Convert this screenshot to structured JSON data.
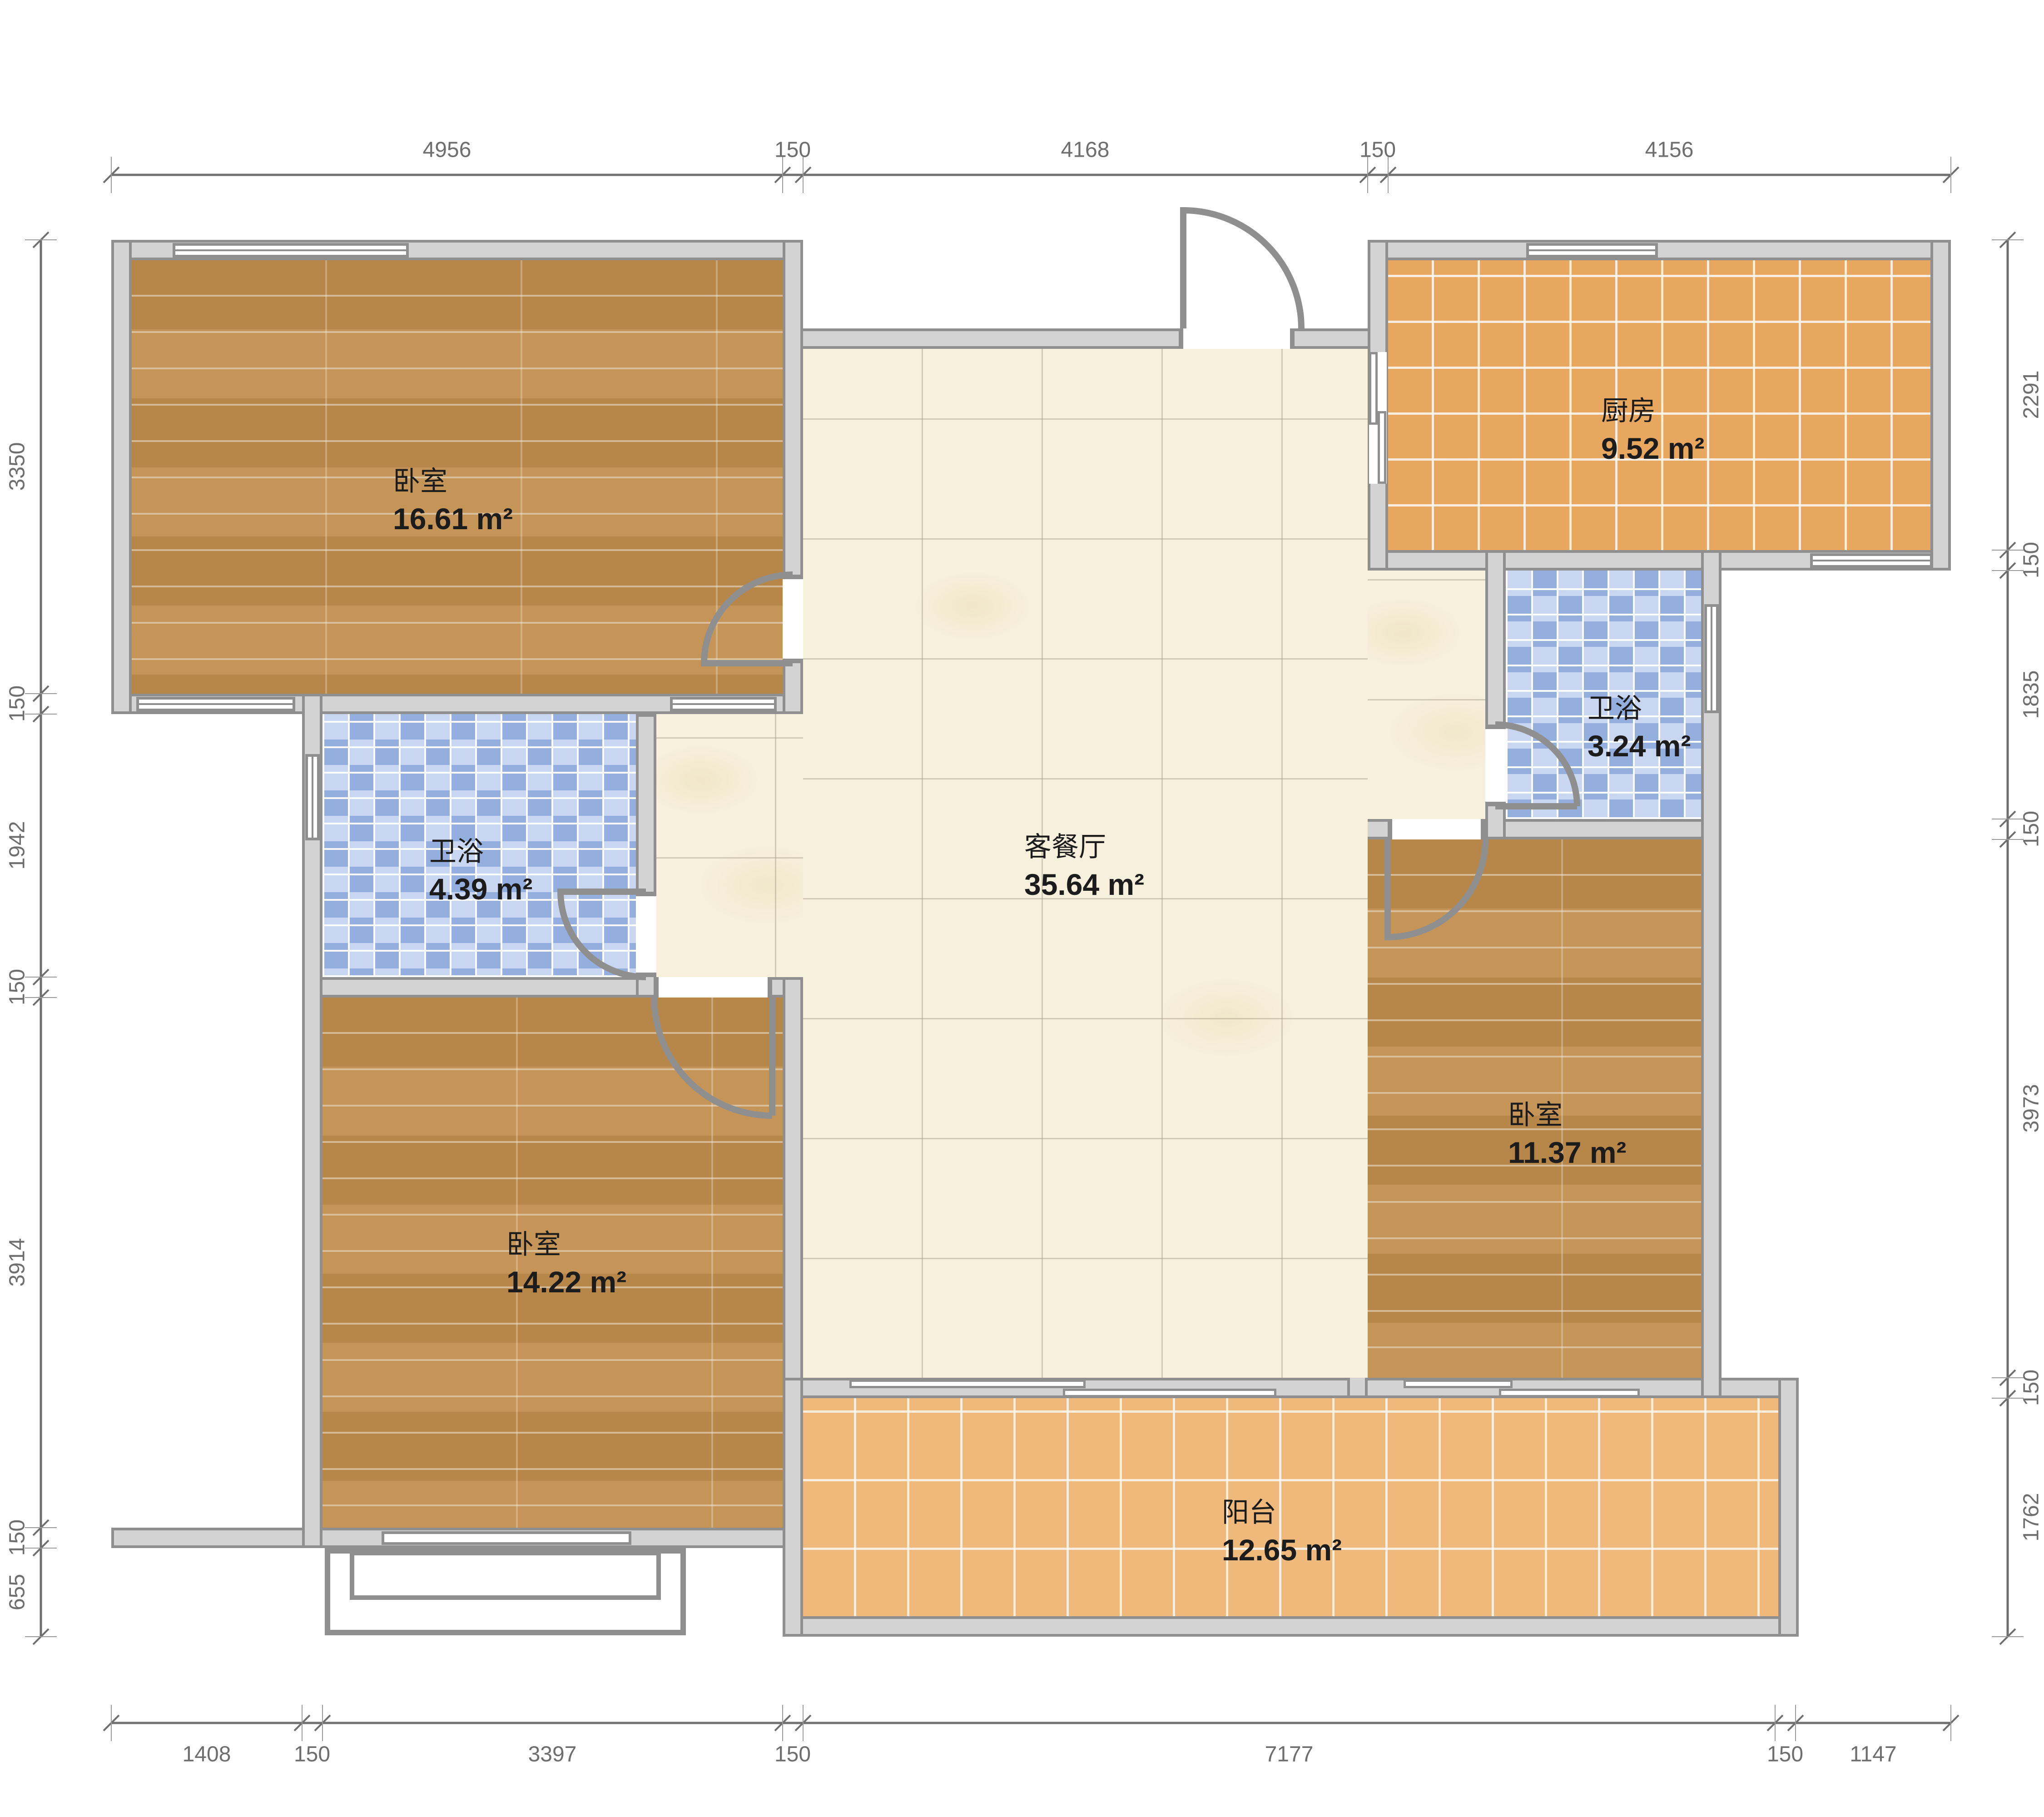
{
  "rooms": {
    "bedroom_top_left": {
      "name": "卧室",
      "area": "16.61 m²"
    },
    "kitchen": {
      "name": "厨房",
      "area": "9.52 m²"
    },
    "bath_left": {
      "name": "卫浴",
      "area": "4.39 m²"
    },
    "bath_right": {
      "name": "卫浴",
      "area": "3.24 m²"
    },
    "living_dining": {
      "name": "客餐厅",
      "area": "35.64 m²"
    },
    "bedroom_bottom_left": {
      "name": "卧室",
      "area": "14.22 m²"
    },
    "bedroom_right": {
      "name": "卧室",
      "area": "11.37 m²"
    },
    "balcony": {
      "name": "阳台",
      "area": "12.65 m²"
    }
  },
  "dimensions_mm": {
    "top": [
      "4956",
      "150",
      "4168",
      "150",
      "4156"
    ],
    "bottom": [
      "1408",
      "150",
      "3397",
      "150",
      "7177",
      "150",
      "1147"
    ],
    "left": [
      "3350",
      "150",
      "1942",
      "150",
      "3914",
      "150",
      "655"
    ],
    "right": [
      "2291",
      "150",
      "1835",
      "150",
      "3973",
      "150",
      "1762"
    ]
  },
  "colors": {
    "wall_fill": "#d3d3d3",
    "wall_line": "#8f8f8f",
    "wood_floor": "#c18e4e",
    "kitchen_tile": "#e8a75e",
    "balcony_tile": "#eeb97a",
    "bath_tile_light": "#cfdaf1",
    "bath_tile_dark": "#94aede",
    "marble_floor": "#f7f0dd",
    "dim_text": "#6e6e6e",
    "label_text": "#1c1c1c"
  }
}
